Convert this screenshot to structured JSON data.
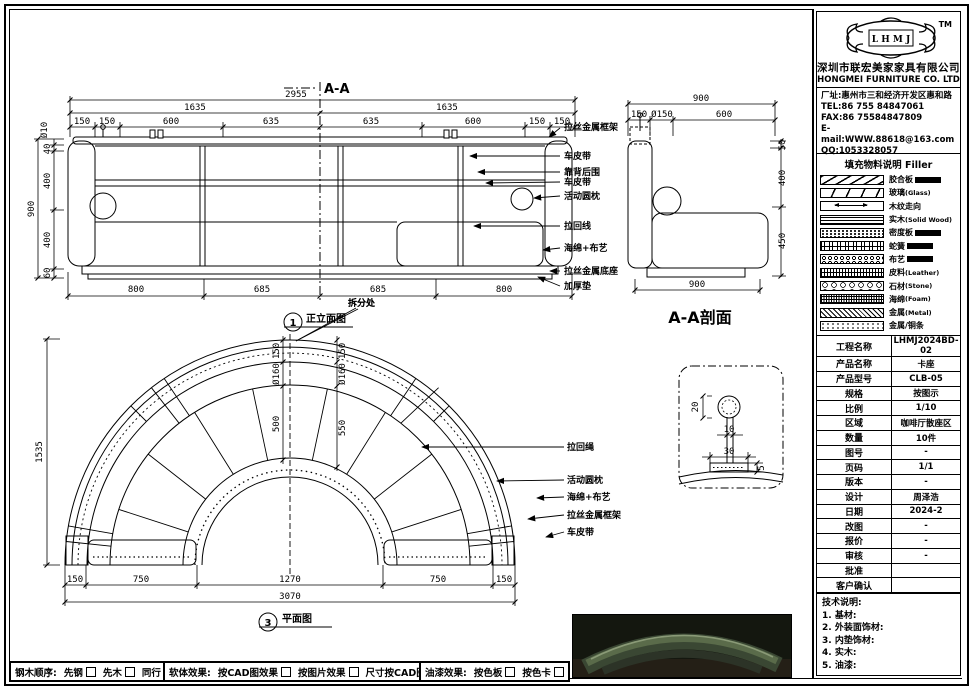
{
  "header": {
    "trademark": "TM",
    "logo_text": "L H M J",
    "company_cn": "深圳市联宏美家家具有限公司",
    "company_en": "HONGMEI FURNITURE CO. LTD"
  },
  "contact": {
    "address": "厂址:惠州市三和经济开发区惠和路",
    "tel": "TEL:86 755 84847061",
    "fax": "FAX:86 75584847809",
    "email": "E-mail:WWW.88618@163.com",
    "qq": "QQ:1053328057"
  },
  "legend": {
    "title": "填充物料说明",
    "title_en": "Filler",
    "items": [
      {
        "label": "胶合板",
        "suffix": ""
      },
      {
        "label": "玻璃",
        "suffix": "(Glass)"
      },
      {
        "label": "木纹走向",
        "suffix": ""
      },
      {
        "label": "实木",
        "suffix": "(Solid Wood)"
      },
      {
        "label": "密度板",
        "suffix": ""
      },
      {
        "label": "蛇簧",
        "suffix": ""
      },
      {
        "label": "布艺",
        "suffix": ""
      },
      {
        "label": "皮料",
        "suffix": "(Leather)"
      },
      {
        "label": "石材",
        "suffix": "(Stone)"
      },
      {
        "label": "海绵",
        "suffix": "(Foam)"
      },
      {
        "label": "金属",
        "suffix": "(Metal)"
      },
      {
        "label": "金属/铜条",
        "suffix": ""
      }
    ]
  },
  "info_table": {
    "rows": [
      {
        "label": "工程名称",
        "value": "LHMJ2024BD-02"
      },
      {
        "label": "产品名称",
        "value": "卡座"
      },
      {
        "label": "产品型号",
        "value": "CLB-05"
      },
      {
        "label": "规格",
        "value": "按图示"
      },
      {
        "label": "比例",
        "value": "1/10"
      },
      {
        "label": "区域",
        "value": "咖啡厅散座区"
      },
      {
        "label": "数量",
        "value": "10件"
      },
      {
        "label": "图号",
        "value": "-"
      },
      {
        "label": "页码",
        "value": "1/1"
      },
      {
        "label": "版本",
        "value": "-"
      },
      {
        "label": "设计",
        "value": "周泽浩"
      },
      {
        "label": "日期",
        "value": "2024-2"
      },
      {
        "label": "改图",
        "value": "-"
      },
      {
        "label": "报价",
        "value": "-"
      },
      {
        "label": "审核",
        "value": "-"
      },
      {
        "label": "批准",
        "value": ""
      },
      {
        "label": "客户确认",
        "value": ""
      }
    ]
  },
  "tech_notes": {
    "title": "技术说明:",
    "items": [
      "1. 基材:",
      "2. 外装面饰材:",
      "3. 内垫饰材:",
      "4. 实木:",
      "5. 油漆:"
    ]
  },
  "bottom_bar": {
    "groups": [
      {
        "label": "钢木顺序:",
        "options": [
          "先钢",
          "先木",
          "同行"
        ]
      },
      {
        "label": "软体效果:",
        "options": [
          "按CAD图效果",
          "按图片效果",
          "尺寸按CAD图纸"
        ]
      },
      {
        "label": "油漆效果:",
        "options": [
          "按色板",
          "按色卡"
        ]
      }
    ]
  },
  "views": {
    "section_mark": "A-A",
    "elevation": {
      "marker_num": "1",
      "marker_label": "正立面图",
      "split_label": "拆分处",
      "dims": {
        "overall": "2955",
        "half_left": "1635",
        "half_right": "1635",
        "top": [
          "150",
          "150",
          "600",
          "635",
          "635",
          "600",
          "150",
          "150"
        ],
        "left_outer": "900",
        "left_chain": [
          "Ø10",
          "40",
          "400",
          "400",
          "60"
        ],
        "bottom": [
          "800",
          "685",
          "685",
          "800"
        ]
      },
      "callouts": [
        "拉丝金属框架",
        "车皮带",
        "靠背后围",
        "车皮带",
        "活动圆枕",
        "拉回线",
        "海绵+布艺",
        "拉丝金属底座",
        "加厚垫"
      ]
    },
    "section": {
      "title": "A-A剖面",
      "dims": {
        "overall_top": "900",
        "top": [
          "150",
          "Ø150",
          "600"
        ],
        "right": [
          "50",
          "400",
          "450"
        ],
        "bottom": "900"
      }
    },
    "plan": {
      "marker_num": "3",
      "marker_label": "平面图",
      "split_label": "拆分处",
      "dims": {
        "height": "1535",
        "bottom": [
          "150",
          "750",
          "1270",
          "750",
          "150"
        ],
        "overall": "3070",
        "chain_left": [
          "150",
          "Ø160",
          "500"
        ],
        "chain_right": [
          "150",
          "Ø160",
          "550"
        ]
      },
      "callouts": [
        "拉回绳",
        "活动圆枕",
        "海绵+布艺",
        "拉丝金属框架",
        "车皮带"
      ]
    },
    "detail": {
      "dims": {
        "d20": "20",
        "d10": "10",
        "d30": "30",
        "d5": "5"
      }
    }
  }
}
